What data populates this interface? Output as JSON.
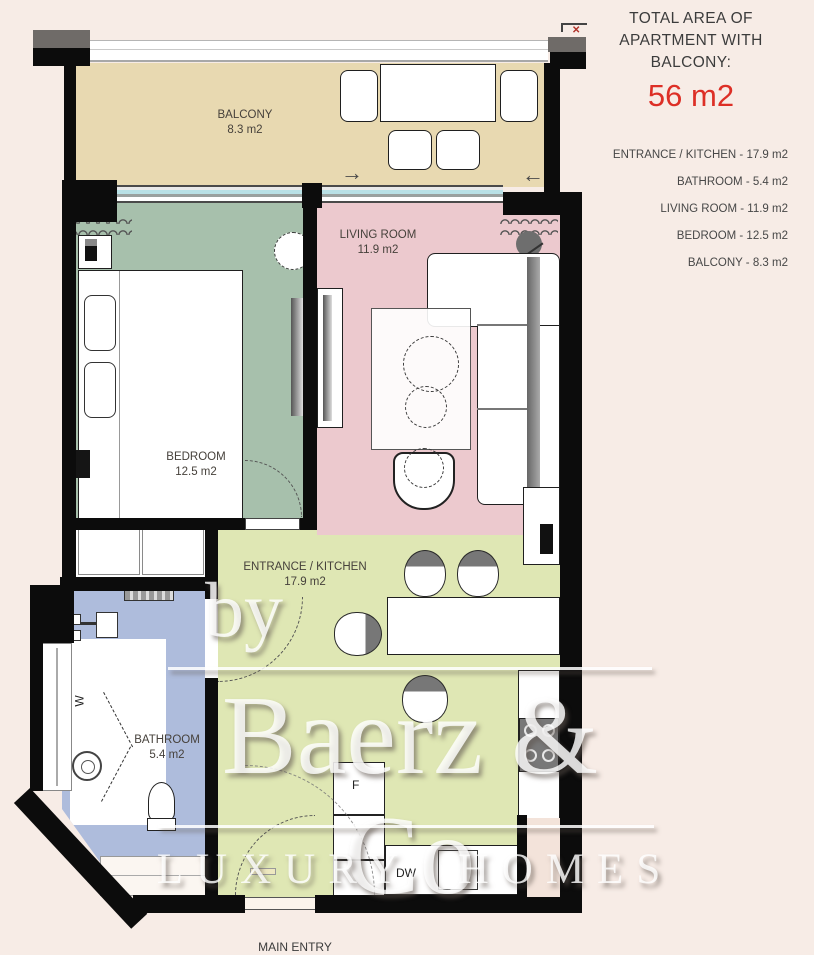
{
  "summary": {
    "title_lines": [
      "TOTAL AREA OF",
      "APARTMENT WITH",
      "BALCONY:"
    ],
    "total_area": "56 m2",
    "rooms": [
      "ENTRANCE / KITCHEN - 17.9 m2",
      "BATHROOM - 5.4 m2",
      "LIVING ROOM - 11.9 m2",
      "BEDROOM - 12.5 m2",
      "BALCONY - 8.3 m2"
    ]
  },
  "plan": {
    "rooms": {
      "balcony": {
        "label": "BALCONY",
        "area": "8.3 m2"
      },
      "bedroom": {
        "label": "BEDROOM",
        "area": "12.5 m2"
      },
      "living": {
        "label": "LIVING ROOM",
        "area": "11.9 m2"
      },
      "kitchen": {
        "label": "ENTRANCE / KITCHEN",
        "area": "17.9 m2"
      },
      "bathroom": {
        "label": "BATHROOM",
        "area": "5.4 m2"
      }
    },
    "main_entry_label": "MAIN ENTRY",
    "appliance_labels": {
      "fridge": "F",
      "dishwasher": "DW",
      "washer": "W"
    },
    "icons": {
      "slide_right": "→",
      "slide_left": "←",
      "marker_x": "✕"
    }
  },
  "watermark": {
    "by": "by",
    "brand": "Baerz & Co",
    "tagline": "LUXURY HOMES"
  },
  "colors": {
    "background": "#f7ece6",
    "balcony": "#e8d9b1",
    "bedroom": "#a7c0ac",
    "living": "#ecc9ce",
    "kitchen": "#dfe7b4",
    "bathroom": "#aebcdc",
    "wall": "#0c0c0c",
    "total_red": "#dd2f26",
    "text_dark": "#3c3c3c",
    "window_glass": "#b9e1e6"
  }
}
